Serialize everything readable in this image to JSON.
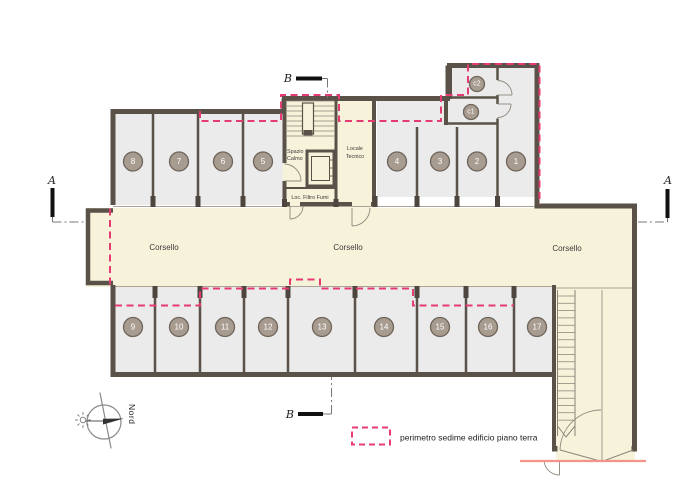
{
  "plan": {
    "corridor_labels": [
      "Corsello",
      "Corsello",
      "Corsello"
    ],
    "rooms": {
      "spazio_calmo_line1": "Spazio",
      "spazio_calmo_line2": "Calmo",
      "locale_tecnico_line1": "Locale",
      "locale_tecnico_line2": "Tecnico",
      "loc_filtro_fumi": "Loc. Filtro Fumi"
    },
    "stalls_top": [
      "8",
      "7",
      "6",
      "5",
      "4",
      "3",
      "2",
      "1"
    ],
    "stalls_bottom": [
      "9",
      "10",
      "11",
      "12",
      "13",
      "14",
      "15",
      "16",
      "17"
    ],
    "cellars": [
      "c2",
      "c1"
    ],
    "section_marks": {
      "a_left": "A",
      "a_right": "A",
      "b_top": "B",
      "b_bottom": "B"
    },
    "north_label": "Nord",
    "legend_text": "perimetro sedime edificio piano terra",
    "colors": {
      "wall": "#5a5248",
      "stall_fill": "#ebebeb",
      "corridor_fill": "#f7f3da",
      "perimeter_dash": "#e63a72",
      "ground_line": "#f2948a",
      "badge_fill": "#a89c91",
      "badge_stroke": "#6e6459",
      "badge_text": "#ffffff"
    }
  }
}
